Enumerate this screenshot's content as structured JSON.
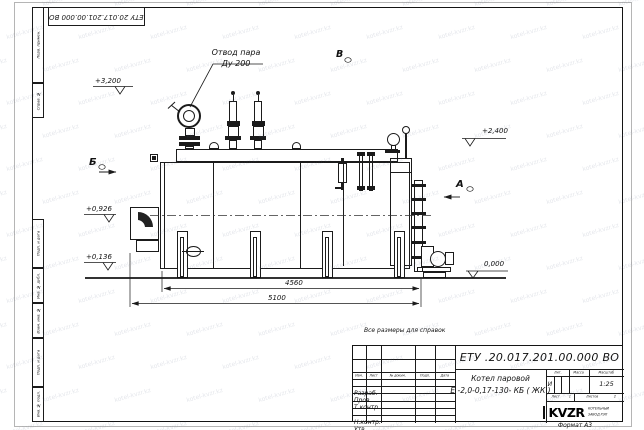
{
  "sheet": {
    "top_stamp": "ЕТУ 20.017.201.00.000  ВО",
    "format_label": "Формат А3",
    "reference_note": "Все размеры для справок",
    "watermark": "kotel-kvzr.kz",
    "side_strip": [
      "Перв. примен.",
      "Справ. №",
      "Подп. и дата",
      "Инв. № дубл.",
      "Взам. инв. №",
      "Подп. и дата",
      "Инв. № подл."
    ]
  },
  "annotations": {
    "steam_outlet_line1": "Отвод пара",
    "steam_outlet_line2": "Ду 200",
    "view_top": "В",
    "view_left": "Б",
    "view_right": "А",
    "elev_3200": "+3,200",
    "elev_2400": "+2,400",
    "elev_0926": "+0,926",
    "elev_0136": "+0,136",
    "elev_0000": "0,000",
    "dim_inner": "4560",
    "dim_outer": "5100"
  },
  "title_block": {
    "doc_number": "ЕТУ .20.017.201.00.000  ВО",
    "product_name_line1": "Котел паровой",
    "product_name_line2": "Е -2,0-0,17-130- КБ ( ЖК )",
    "header_cols": [
      "Изм.",
      "Лист",
      "№ докум.",
      "Подп.",
      "Дата"
    ],
    "rows": [
      "Разраб.",
      "Пров.",
      "Т.контр.",
      "",
      "Н.контр.",
      "Утв."
    ],
    "lit_label": "Лит.",
    "mass_label": "Масса",
    "scale_label": "Масштаб",
    "lit_value": "И",
    "scale_value": "1:25",
    "sheet_label": "Лист",
    "sheet_value": "1",
    "sheets_label": "Листов",
    "sheets_value": "2",
    "logo_text": "KVZR",
    "logo_sub1": "КОТЕЛЬНЫЙ",
    "logo_sub2": "ЗАВОД РЭП"
  }
}
